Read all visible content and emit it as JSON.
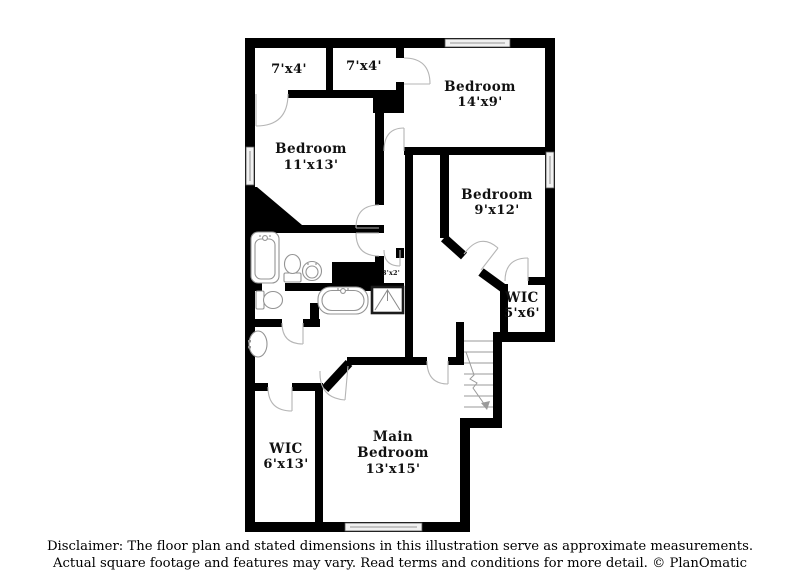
{
  "floor_plan": {
    "rooms": [
      {
        "id": "closet-top-left",
        "name": "",
        "dims": "7'x4'"
      },
      {
        "id": "closet-top-right",
        "name": "",
        "dims": "7'x4'"
      },
      {
        "id": "bedroom-14x9",
        "name": "Bedroom",
        "dims": "14'x9'"
      },
      {
        "id": "bedroom-11x13",
        "name": "Bedroom",
        "dims": "11'x13'"
      },
      {
        "id": "bedroom-9x12",
        "name": "Bedroom",
        "dims": "9'x12'"
      },
      {
        "id": "closet-3x2",
        "name": "",
        "dims": "3'x2'"
      },
      {
        "id": "wic-5x6",
        "name": "WIC",
        "dims": "5'x6'"
      },
      {
        "id": "wic-6x13",
        "name": "WIC",
        "dims": "6'x13'"
      },
      {
        "id": "main-bedroom",
        "name": "Main",
        "name2": "Bedroom",
        "dims": "13'x15'"
      }
    ],
    "fixtures": [
      "bathtub",
      "toilet",
      "pedestal-sink",
      "toilet",
      "bathtub",
      "shower",
      "vanity-sink",
      "staircase"
    ],
    "colors": {
      "wall": "#000000",
      "door_arc": "#b5b5b5",
      "window_fill": "#f1f1f1",
      "background": "#ffffff"
    }
  },
  "disclaimer": {
    "line1": "Disclaimer: The floor plan and stated dimensions in this illustration serve as approximate measurements.",
    "line2": "Actual square footage and features may vary. Read terms and conditions for more detail. © PlanOmatic"
  }
}
